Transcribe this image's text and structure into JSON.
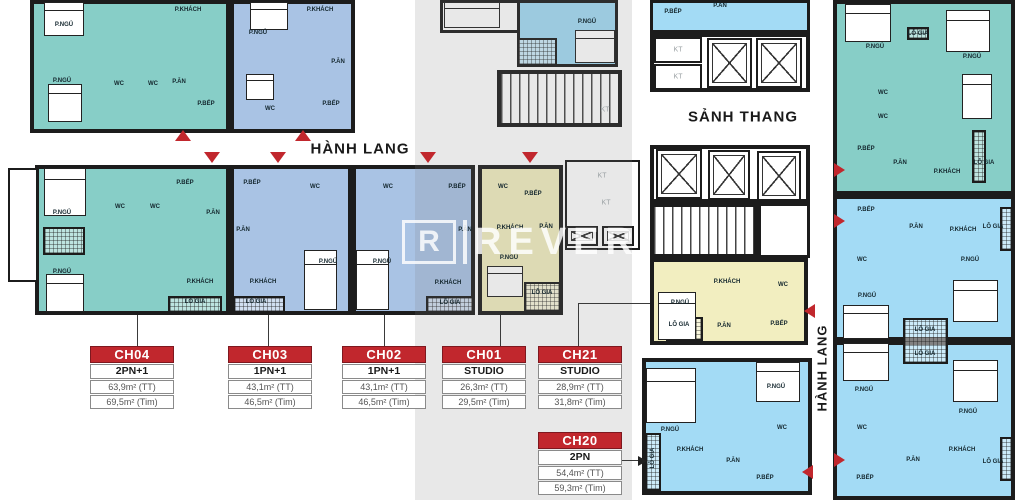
{
  "colors": {
    "teal": "#87CEC7",
    "periwinkle": "#A9C3E4",
    "lightblue": "#A3DBF5",
    "yellow": "#F2EEC0",
    "red": "#C1272D",
    "wall": "#1C1C1C"
  },
  "corridor": {
    "horizontal_label": "HÀNH LANG",
    "vertical_label": "HÀNH LANG",
    "stair_lobby_label": "SẢNH THANG"
  },
  "watermark": {
    "letter": "R",
    "word": "REVER"
  },
  "room_labels": {
    "bedroom": "P.NGỦ",
    "living": "P.KHÁCH",
    "kitchen": "P.BẾP",
    "dining": "P.ĂN",
    "wc": "WC",
    "loggia": "LÔ GIA",
    "tech": "KT"
  },
  "unit_cards": [
    {
      "code": "CH04",
      "type": "2PN+1",
      "area_tt": "63,9m² (TT)",
      "area_tim": "69,5m² (Tim)"
    },
    {
      "code": "CH03",
      "type": "1PN+1",
      "area_tt": "43,1m² (TT)",
      "area_tim": "46,5m² (Tim)"
    },
    {
      "code": "CH02",
      "type": "1PN+1",
      "area_tt": "43,1m² (TT)",
      "area_tim": "46,5m² (Tim)"
    },
    {
      "code": "CH01",
      "type": "STUDIO",
      "area_tt": "26,3m² (TT)",
      "area_tim": "29,5m² (Tim)"
    },
    {
      "code": "CH21",
      "type": "STUDIO",
      "area_tt": "28,9m² (TT)",
      "area_tim": "31,8m² (Tim)"
    },
    {
      "code": "CH20",
      "type": "2PN",
      "area_tt": "54,4m² (TT)",
      "area_tim": "59,3m² (Tim)"
    }
  ]
}
